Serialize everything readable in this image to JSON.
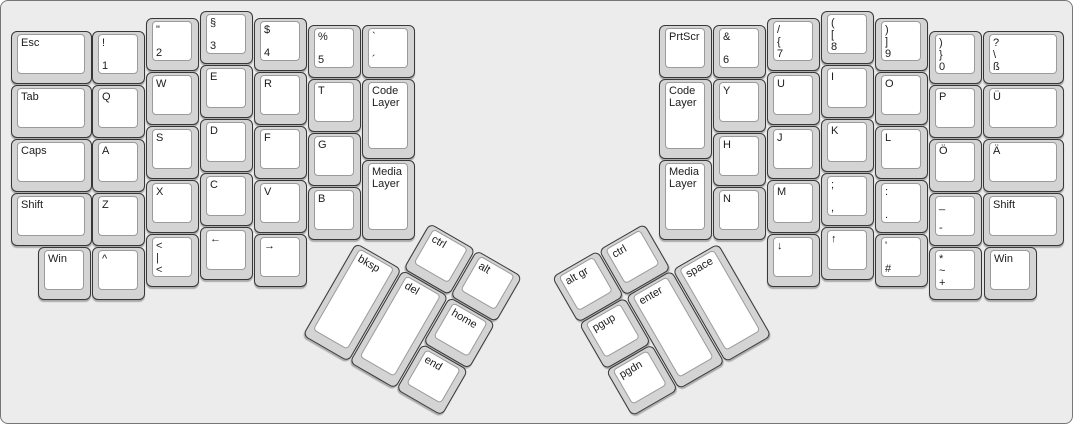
{
  "canvas": {
    "bg": "#ececec",
    "key_cap": "#d4d4d4",
    "key_cap_border": "#383838",
    "key_top": "#ffffff",
    "key_top_border": "#9b9b9b",
    "label_color": "#1c1c1c"
  },
  "groups": [
    {
      "name": "left-main",
      "type": "grid",
      "origin": {
        "x": 0,
        "y": 0
      },
      "rotation": 0,
      "keys": [
        {
          "n": "key-esc",
          "labels": [
            "Esc"
          ],
          "x": 10,
          "y": 30,
          "w": 81
        },
        {
          "n": "key-tab",
          "labels": [
            "Tab"
          ],
          "x": 10,
          "y": 84,
          "w": 81
        },
        {
          "n": "key-caps",
          "labels": [
            "Caps"
          ],
          "x": 10,
          "y": 138,
          "w": 81
        },
        {
          "n": "key-shift-left",
          "labels": [
            "Shift"
          ],
          "x": 10,
          "y": 192,
          "w": 81
        },
        {
          "n": "key-win-left",
          "labels": [
            "Win"
          ],
          "x": 37,
          "y": 246
        },
        {
          "n": "key-1",
          "labels": [
            "!",
            "1"
          ],
          "x": 91,
          "y": 30
        },
        {
          "n": "key-q",
          "labels": [
            "Q"
          ],
          "x": 91,
          "y": 84
        },
        {
          "n": "key-a",
          "labels": [
            "A"
          ],
          "x": 91,
          "y": 138
        },
        {
          "n": "key-z",
          "labels": [
            "Z"
          ],
          "x": 91,
          "y": 192
        },
        {
          "n": "key-circumflex",
          "labels": [
            "^"
          ],
          "x": 91,
          "y": 246
        },
        {
          "n": "key-2",
          "labels": [
            "\"",
            "2"
          ],
          "x": 145,
          "y": 17
        },
        {
          "n": "key-w",
          "labels": [
            "W"
          ],
          "x": 145,
          "y": 71
        },
        {
          "n": "key-s",
          "labels": [
            "S"
          ],
          "x": 145,
          "y": 125
        },
        {
          "n": "key-x",
          "labels": [
            "X"
          ],
          "x": 145,
          "y": 179
        },
        {
          "n": "key-angle-pipe",
          "labels": [
            "<",
            "|",
            "<"
          ],
          "x": 145,
          "y": 233
        },
        {
          "n": "key-3",
          "labels": [
            "§",
            "3"
          ],
          "x": 199,
          "y": 10
        },
        {
          "n": "key-e",
          "labels": [
            "E"
          ],
          "x": 199,
          "y": 64
        },
        {
          "n": "key-d",
          "labels": [
            "D"
          ],
          "x": 199,
          "y": 118
        },
        {
          "n": "key-c",
          "labels": [
            "C"
          ],
          "x": 199,
          "y": 172
        },
        {
          "n": "key-arrow-left",
          "labels": [
            "←"
          ],
          "x": 199,
          "y": 226
        },
        {
          "n": "key-4",
          "labels": [
            "$",
            "4"
          ],
          "x": 253,
          "y": 17
        },
        {
          "n": "key-r",
          "labels": [
            "R"
          ],
          "x": 253,
          "y": 71
        },
        {
          "n": "key-f",
          "labels": [
            "F"
          ],
          "x": 253,
          "y": 125
        },
        {
          "n": "key-v",
          "labels": [
            "V"
          ],
          "x": 253,
          "y": 179
        },
        {
          "n": "key-arrow-right",
          "labels": [
            "→"
          ],
          "x": 253,
          "y": 233
        },
        {
          "n": "key-5",
          "labels": [
            "%",
            "5"
          ],
          "x": 307,
          "y": 24
        },
        {
          "n": "key-t",
          "labels": [
            "T"
          ],
          "x": 307,
          "y": 78
        },
        {
          "n": "key-g",
          "labels": [
            "G"
          ],
          "x": 307,
          "y": 132
        },
        {
          "n": "key-b",
          "labels": [
            "B"
          ],
          "x": 307,
          "y": 186
        },
        {
          "n": "key-grave-acute",
          "labels": [
            "`",
            "´"
          ],
          "x": 361,
          "y": 24
        },
        {
          "n": "key-code-layer-left",
          "labels": [
            "Code Layer"
          ],
          "x": 361,
          "y": 78,
          "h": 80
        },
        {
          "n": "key-media-layer-left",
          "labels": [
            "Media Layer"
          ],
          "x": 361,
          "y": 159,
          "h": 80
        }
      ]
    },
    {
      "name": "left-thumb-cluster",
      "type": "cluster",
      "origin": {
        "x": 382,
        "y": 195
      },
      "rotation": 30,
      "keys": [
        {
          "n": "key-ctrl-left",
          "labels": [
            "ctrl"
          ],
          "x": 54,
          "y": 0
        },
        {
          "n": "key-alt",
          "labels": [
            "alt"
          ],
          "x": 108,
          "y": 0
        },
        {
          "n": "key-bksp",
          "labels": [
            "bksp"
          ],
          "x": 0,
          "y": 54,
          "h": 107
        },
        {
          "n": "key-del",
          "labels": [
            "del"
          ],
          "x": 54,
          "y": 54,
          "h": 107
        },
        {
          "n": "key-home",
          "labels": [
            "home"
          ],
          "x": 108,
          "y": 54
        },
        {
          "n": "key-end",
          "labels": [
            "end"
          ],
          "x": 108,
          "y": 108
        }
      ]
    },
    {
      "name": "right-thumb-cluster",
      "type": "cluster",
      "origin": {
        "x": 529,
        "y": 195
      },
      "rotation": -30,
      "keys": [
        {
          "n": "key-altgr",
          "labels": [
            "alt gr"
          ],
          "x": 0,
          "y": 0
        },
        {
          "n": "key-ctrl-right",
          "labels": [
            "ctrl"
          ],
          "x": 54,
          "y": 0
        },
        {
          "n": "key-pgup",
          "labels": [
            "pgup"
          ],
          "x": 0,
          "y": 54
        },
        {
          "n": "key-enter",
          "labels": [
            "enter"
          ],
          "x": 54,
          "y": 54,
          "h": 107
        },
        {
          "n": "key-space",
          "labels": [
            "space"
          ],
          "x": 108,
          "y": 54,
          "h": 107
        },
        {
          "n": "key-pgdn",
          "labels": [
            "pgdn"
          ],
          "x": 0,
          "y": 108
        }
      ]
    },
    {
      "name": "right-main",
      "type": "grid",
      "origin": {
        "x": 0,
        "y": 0
      },
      "rotation": 0,
      "keys": [
        {
          "n": "key-prtscr",
          "labels": [
            "PrtScr"
          ],
          "x": 658,
          "y": 24
        },
        {
          "n": "key-code-layer-right",
          "labels": [
            "Code Layer"
          ],
          "x": 658,
          "y": 78,
          "h": 80
        },
        {
          "n": "key-media-layer-right",
          "labels": [
            "Media Layer"
          ],
          "x": 658,
          "y": 159,
          "h": 80
        },
        {
          "n": "key-6",
          "labels": [
            "&",
            "6"
          ],
          "x": 712,
          "y": 24
        },
        {
          "n": "key-y",
          "labels": [
            "Y"
          ],
          "x": 712,
          "y": 78
        },
        {
          "n": "key-h",
          "labels": [
            "H"
          ],
          "x": 712,
          "y": 132
        },
        {
          "n": "key-n",
          "labels": [
            "N"
          ],
          "x": 712,
          "y": 186
        },
        {
          "n": "key-7",
          "labels": [
            "/",
            "{",
            "7"
          ],
          "x": 766,
          "y": 17
        },
        {
          "n": "key-u",
          "labels": [
            "U"
          ],
          "x": 766,
          "y": 71
        },
        {
          "n": "key-j",
          "labels": [
            "J"
          ],
          "x": 766,
          "y": 125
        },
        {
          "n": "key-m",
          "labels": [
            "M"
          ],
          "x": 766,
          "y": 179
        },
        {
          "n": "key-arrow-down",
          "labels": [
            "↓"
          ],
          "x": 766,
          "y": 233
        },
        {
          "n": "key-8",
          "labels": [
            "(",
            "[",
            "8"
          ],
          "x": 820,
          "y": 10
        },
        {
          "n": "key-i",
          "labels": [
            "I"
          ],
          "x": 820,
          "y": 64
        },
        {
          "n": "key-k",
          "labels": [
            "K"
          ],
          "x": 820,
          "y": 118
        },
        {
          "n": "key-semicolon",
          "labels": [
            ";",
            ","
          ],
          "x": 820,
          "y": 172
        },
        {
          "n": "key-arrow-up",
          "labels": [
            "↑"
          ],
          "x": 820,
          "y": 226
        },
        {
          "n": "key-9",
          "labels": [
            ")",
            "]",
            "9"
          ],
          "x": 874,
          "y": 17
        },
        {
          "n": "key-o",
          "labels": [
            "O"
          ],
          "x": 874,
          "y": 71
        },
        {
          "n": "key-l",
          "labels": [
            "L"
          ],
          "x": 874,
          "y": 125
        },
        {
          "n": "key-colon",
          "labels": [
            ":",
            "."
          ],
          "x": 874,
          "y": 179
        },
        {
          "n": "key-quote-hash",
          "labels": [
            "'",
            "#"
          ],
          "x": 874,
          "y": 233
        },
        {
          "n": "key-0",
          "labels": [
            ")",
            "}",
            "0"
          ],
          "x": 928,
          "y": 30
        },
        {
          "n": "key-p",
          "labels": [
            "P"
          ],
          "x": 928,
          "y": 84
        },
        {
          "n": "key-o-umlaut",
          "labels": [
            "Ö"
          ],
          "x": 928,
          "y": 138
        },
        {
          "n": "key-underscore-dash",
          "labels": [
            "_",
            "-"
          ],
          "x": 928,
          "y": 192
        },
        {
          "n": "key-asterisk-tilde-plus",
          "labels": [
            "*",
            "~",
            "+"
          ],
          "x": 928,
          "y": 246
        },
        {
          "n": "key-eszett",
          "labels": [
            "?",
            "\\",
            "ß"
          ],
          "x": 982,
          "y": 30,
          "w": 81
        },
        {
          "n": "key-u-umlaut",
          "labels": [
            "Ü"
          ],
          "x": 982,
          "y": 84,
          "w": 81
        },
        {
          "n": "key-a-umlaut",
          "labels": [
            "Ä"
          ],
          "x": 982,
          "y": 138,
          "w": 81
        },
        {
          "n": "key-shift-right",
          "labels": [
            "Shift"
          ],
          "x": 982,
          "y": 192,
          "w": 81
        },
        {
          "n": "key-win-right",
          "labels": [
            "Win"
          ],
          "x": 983,
          "y": 246
        }
      ]
    }
  ]
}
